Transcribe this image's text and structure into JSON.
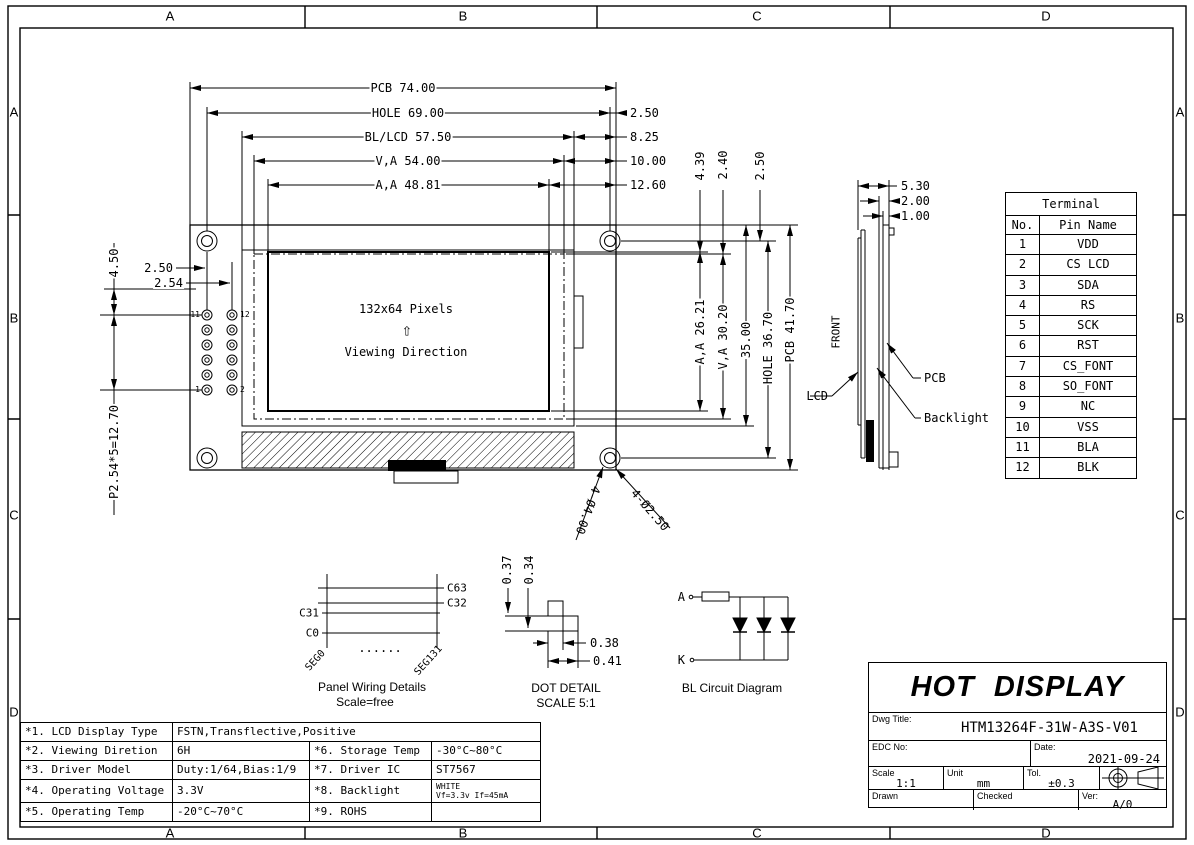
{
  "colors": {
    "line": "#000000",
    "paper": "#ffffff"
  },
  "zones": {
    "top": [
      "A",
      "B",
      "C",
      "D"
    ],
    "bottom": [
      "A",
      "B",
      "C",
      "D"
    ],
    "left": [
      "A",
      "B",
      "C",
      "D"
    ],
    "right": [
      "A",
      "B",
      "C",
      "D"
    ]
  },
  "front_view": {
    "dims_top": [
      "PCB 74.00",
      "HOLE 69.00",
      "BL/LCD 57.50",
      "V,A 54.00",
      "A,A 48.81"
    ],
    "dims_top_right": [
      "2.50",
      "8.25",
      "10.00",
      "12.60"
    ],
    "dims_right": [
      "4.39",
      "2.40",
      "2.50",
      "A,A 26.21",
      "V,A 30.20",
      "35.00",
      "HOLE 36.70",
      "PCB 41.70"
    ],
    "dims_left": [
      "2.50",
      "2.54",
      "4.50",
      "P2.54*5=12.70"
    ],
    "hole_labels": [
      "4-Ø4.00",
      "4-Ø2.50"
    ],
    "display": {
      "pixels": "132x64 Pixels",
      "arrow": "⇧",
      "viewing": "Viewing Direction"
    },
    "pin_labels": {
      "top_left": "11",
      "top_right": "12",
      "bottom_left": "1",
      "bottom_right": "2"
    }
  },
  "side_view": {
    "dims": [
      "5.30",
      "2.00",
      "1.00"
    ],
    "front_label": "FRONT",
    "labels": {
      "lcd": "LCD",
      "pcb": "PCB",
      "backlight": "Backlight"
    }
  },
  "terminal_table": {
    "title": "Terminal",
    "headers": [
      "No.",
      "Pin Name"
    ],
    "rows": [
      [
        "1",
        "VDD"
      ],
      [
        "2",
        "CS LCD"
      ],
      [
        "3",
        "SDA"
      ],
      [
        "4",
        "RS"
      ],
      [
        "5",
        "SCK"
      ],
      [
        "6",
        "RST"
      ],
      [
        "7",
        "CS_FONT"
      ],
      [
        "8",
        "SO_FONT"
      ],
      [
        "9",
        "NC"
      ],
      [
        "10",
        "VSS"
      ],
      [
        "11",
        "BLA"
      ],
      [
        "12",
        "BLK"
      ]
    ]
  },
  "panel_wiring": {
    "c63": "C63",
    "c32": "C32",
    "c31": "C31",
    "c0": "C0",
    "seg_left": "SEG0",
    "seg_right": "SEG131",
    "dots": "......",
    "caption": "Panel Wiring Details",
    "scale_note": "Scale=free"
  },
  "dot_detail": {
    "dims": [
      "0.37",
      "0.34",
      "0.38",
      "0.41"
    ],
    "caption": "DOT DETAIL",
    "scale_note": "SCALE 5:1"
  },
  "bl_circuit": {
    "anode": "A",
    "cathode": "K",
    "caption": "BL Circuit Diagram"
  },
  "title_block": {
    "brand": "HOT DISPLAY",
    "dwg_title_label": "Dwg Title:",
    "dwg_title": "HTM13264F-31W-A3S-V01",
    "edc_label": "EDC No:",
    "date_label": "Date:",
    "date": "2021-09-24",
    "scale_label": "Scale",
    "scale": "1:1",
    "unit_label": "Unit",
    "unit": "mm",
    "tol_label": "Tol.",
    "tol": "±0.3",
    "drawn_label": "Drawn",
    "checked_label": "Checked",
    "ver_label": "Ver:",
    "ver": "A/0"
  },
  "spec_table": {
    "rows": [
      {
        "c1": "*1. LCD Display Type",
        "c2": "FSTN,Transflective,Positive"
      },
      {
        "c1": "*2. Viewing Diretion",
        "c2": "6H",
        "c3": "*6. Storage Temp",
        "c4": "-30°C~80°C"
      },
      {
        "c1": "*3. Driver Model",
        "c2": "Duty:1/64,Bias:1/9",
        "c3": "*7. Driver IC",
        "c4": "ST7567"
      },
      {
        "c1": "*4. Operating Voltage",
        "c2": "3.3V",
        "c3": "*8. Backlight",
        "c4a": "WHITE",
        "c4b": "Vf=3.3v If=45mA"
      },
      {
        "c1": "*5. Operating Temp",
        "c2": "-20°C~70°C",
        "c3": "*9. ROHS",
        "c4": ""
      }
    ]
  }
}
